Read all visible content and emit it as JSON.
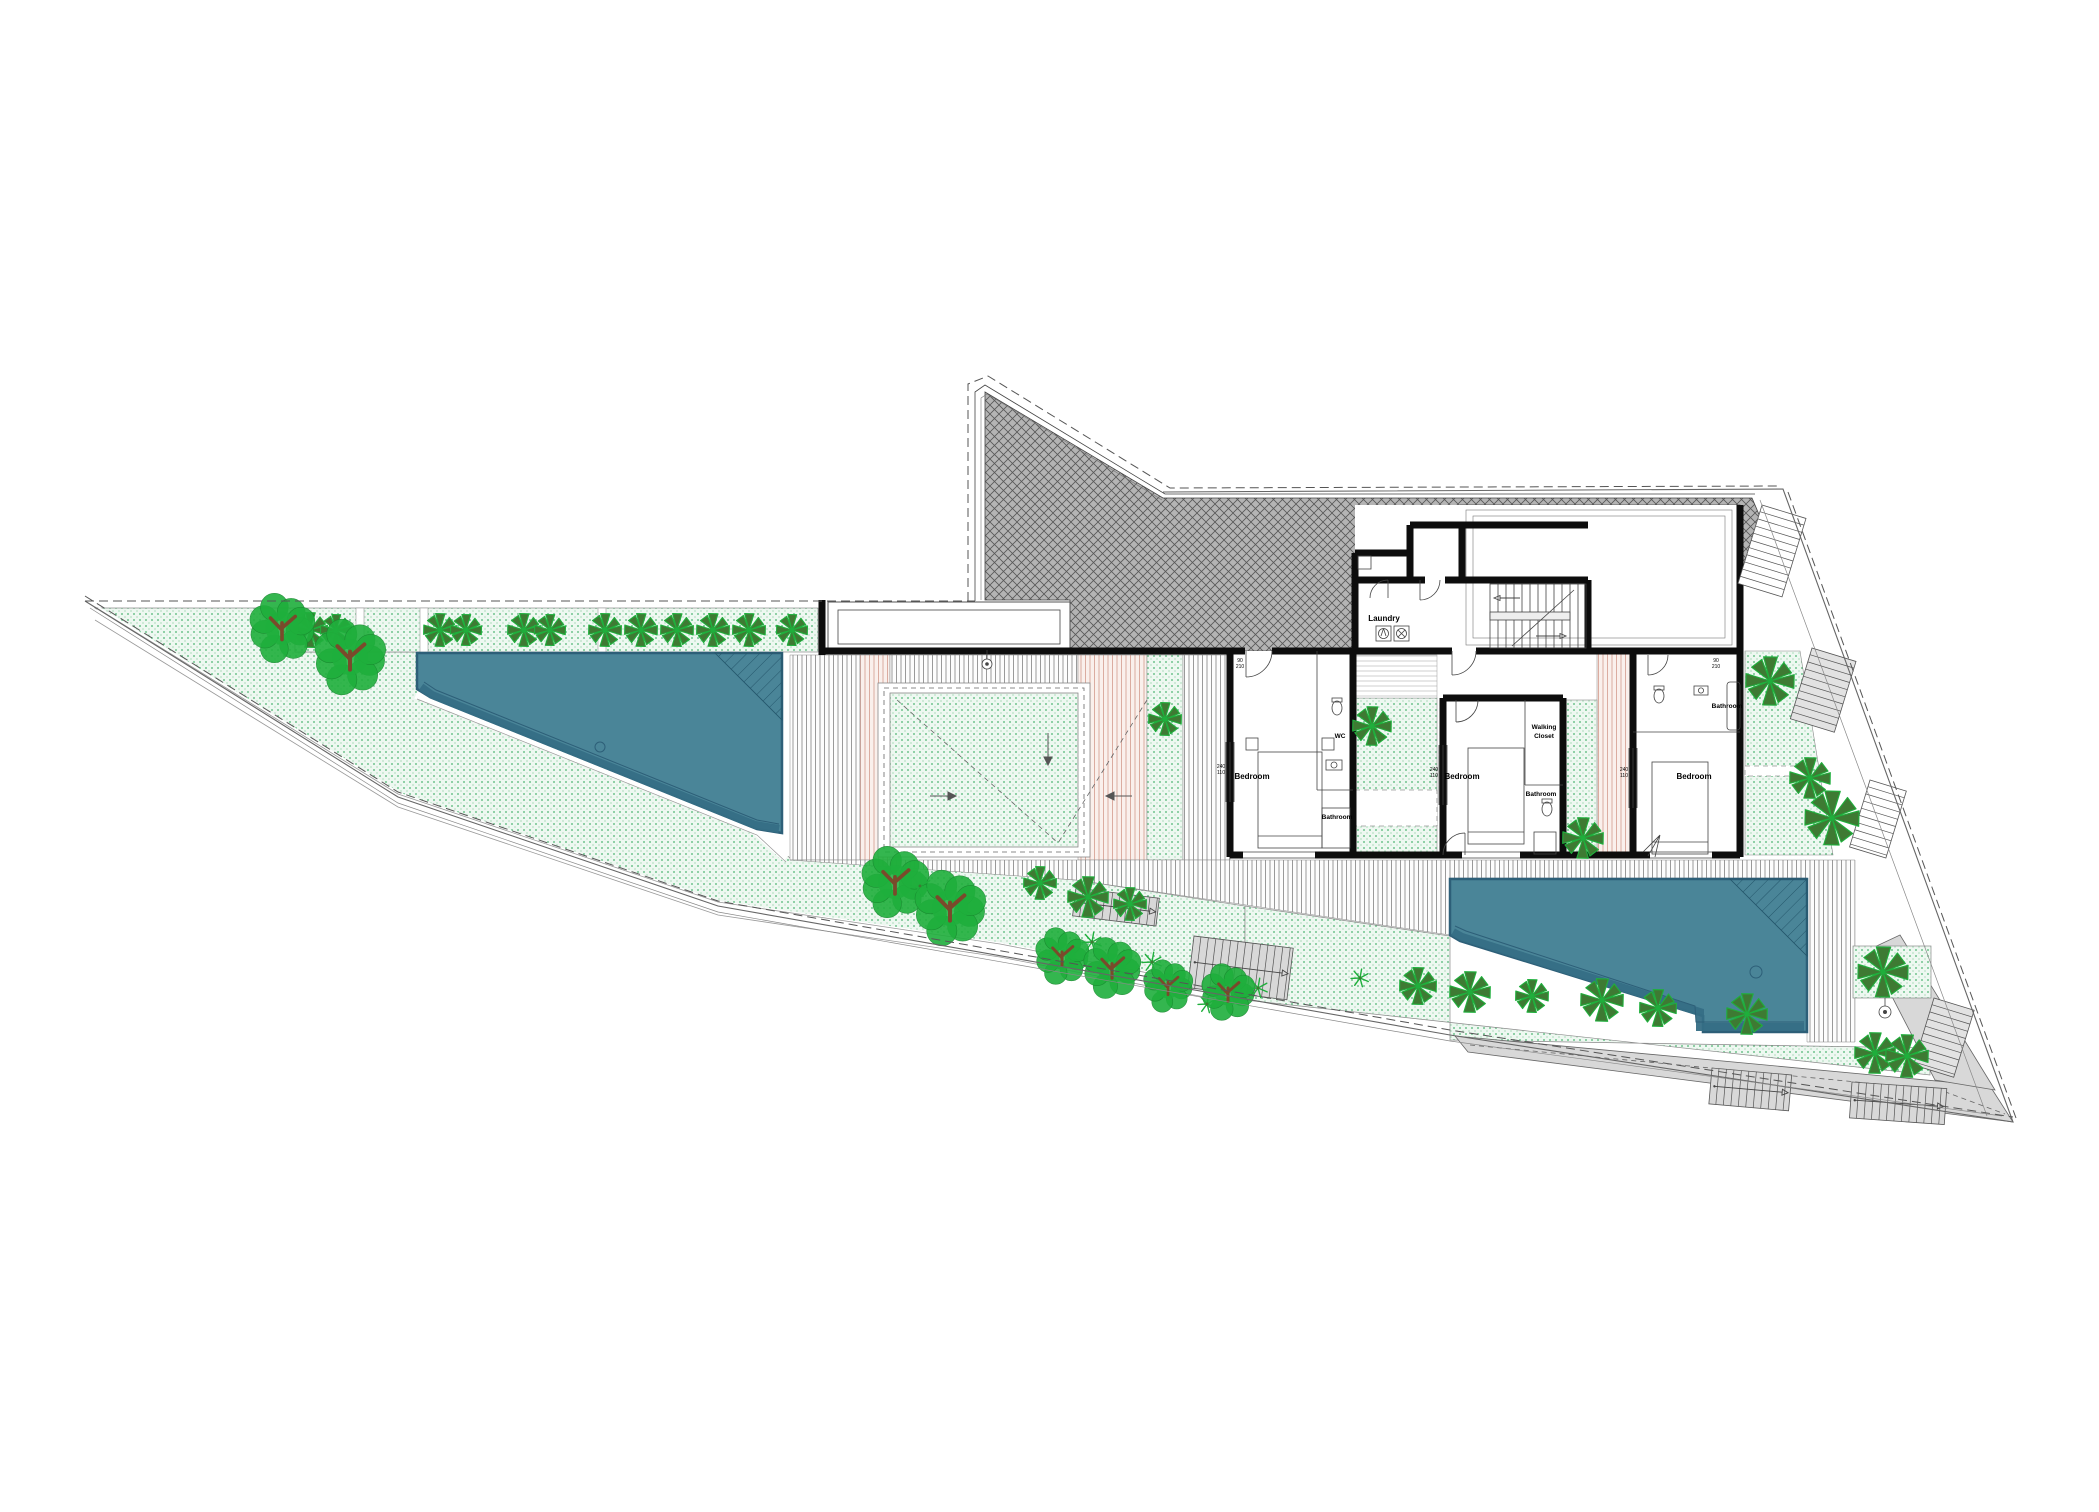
{
  "labels": {
    "laundry": "Laundry",
    "bedroom": "Bedroom",
    "bathroom": "Bathroom",
    "wc": "WC",
    "walking_closet_line1": "Walking",
    "walking_closet_line2": "Closet"
  },
  "dimension_tags": {
    "window_width": "240",
    "window_height": "110",
    "door_width": "90",
    "door_height": "210"
  },
  "colors": {
    "pool_water": "#4a8598",
    "pool_edge": "#2d5f78",
    "pool_band": "#35romoted",
    "pool_band_fix": "#356e85",
    "lawn_dot": "#2fa85a",
    "lawn_bg": "#eef8f1",
    "roof_bg": "#b4b4b4",
    "roof_line": "#585858",
    "deck_line": "#8f8f8f",
    "deck_salmon_line": "#d8a498",
    "deck_salmon_bg": "#faf0ec",
    "walkway": "#d8d8d8",
    "wall": "#0d0d0d",
    "boundary": "#555555",
    "tree_dark": "#3e7a33",
    "tree_bright": "#1faf3c",
    "tree_branch": "#7a4a2b"
  },
  "landscape": {
    "pinwheel_trees": [
      [
        310,
        630,
        18
      ],
      [
        336,
        630,
        16
      ],
      [
        440,
        630,
        17
      ],
      [
        466,
        630,
        16
      ],
      [
        524,
        630,
        17
      ],
      [
        550,
        630,
        16
      ],
      [
        605,
        630,
        17
      ],
      [
        641,
        630,
        17
      ],
      [
        677,
        630,
        17
      ],
      [
        713,
        630,
        17
      ],
      [
        749,
        630,
        17
      ],
      [
        792,
        630,
        16
      ],
      [
        1372,
        726,
        20
      ],
      [
        1583,
        838,
        21
      ],
      [
        1770,
        681,
        25
      ],
      [
        1810,
        778,
        21
      ],
      [
        1832,
        818,
        28
      ],
      [
        1165,
        719,
        17
      ],
      [
        1040,
        883,
        17
      ],
      [
        1088,
        897,
        21
      ],
      [
        1130,
        904,
        17
      ],
      [
        1418,
        986,
        19
      ],
      [
        1470,
        992,
        21
      ],
      [
        1532,
        996,
        17
      ],
      [
        1602,
        1000,
        22
      ],
      [
        1658,
        1008,
        19
      ],
      [
        1747,
        1014,
        21
      ],
      [
        1883,
        972,
        26
      ],
      [
        1875,
        1053,
        21
      ],
      [
        1907,
        1056,
        22
      ]
    ],
    "leafy_trees": [
      [
        282,
        628,
        33
      ],
      [
        350,
        657,
        36
      ],
      [
        895,
        882,
        34
      ],
      [
        950,
        908,
        36
      ],
      [
        1062,
        956,
        27
      ],
      [
        1112,
        968,
        29
      ],
      [
        1168,
        986,
        25
      ],
      [
        1228,
        992,
        27
      ]
    ],
    "palm_sprigs": [
      [
        920,
        886,
        11
      ],
      [
        1092,
        942,
        10
      ],
      [
        1152,
        962,
        10
      ],
      [
        1207,
        1004,
        9
      ],
      [
        1258,
        988,
        10
      ],
      [
        1360,
        978,
        9
      ]
    ]
  },
  "stairs": [
    {
      "x": 1762,
      "y": 505,
      "w": 46,
      "h": 82,
      "rot": 17,
      "rung": "h",
      "fill": "none"
    },
    {
      "x": 1812,
      "y": 648,
      "w": 46,
      "h": 74,
      "rot": 17,
      "rung": "h",
      "fill": "#e2e2e2"
    },
    {
      "x": 1870,
      "y": 780,
      "w": 38,
      "h": 70,
      "rot": 17,
      "rung": "h",
      "fill": "none"
    },
    {
      "x": 1934,
      "y": 998,
      "w": 42,
      "h": 70,
      "rot": 17,
      "rung": "h",
      "fill": "#e2e2e2"
    },
    {
      "x": 1712,
      "y": 1068,
      "w": 80,
      "h": 36,
      "rot": 5,
      "rung": "v",
      "fill": "#d8d8d8",
      "arrow": true
    },
    {
      "x": 1852,
      "y": 1082,
      "w": 95,
      "h": 36,
      "rot": 4,
      "rung": "v",
      "fill": "#d8d8d8",
      "arrow": true
    },
    {
      "x": 1076,
      "y": 888,
      "w": 84,
      "h": 28,
      "rot": 7,
      "rung": "v",
      "fill": "#d8d8d8",
      "arrow": true
    },
    {
      "x": 1194,
      "y": 936,
      "w": 100,
      "h": 52,
      "rot": 7,
      "rung": "v",
      "fill": "#d8d8d8",
      "arrow": true
    }
  ]
}
